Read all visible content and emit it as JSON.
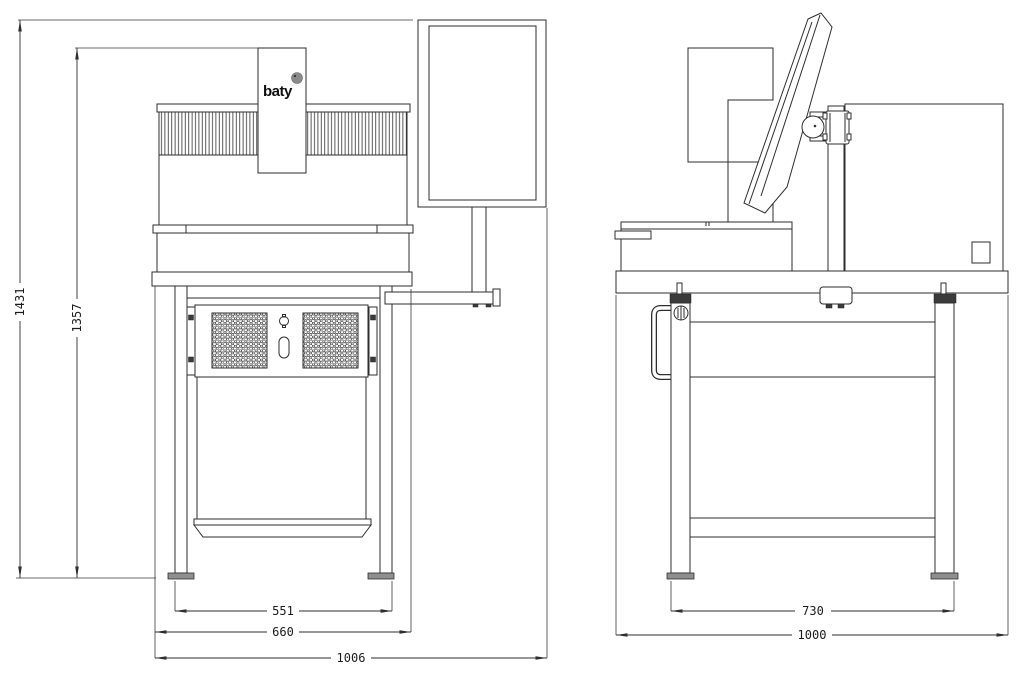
{
  "drawing": {
    "logo": {
      "text": "baty"
    },
    "colors": {
      "line": "#2e2e2e",
      "background": "#ffffff",
      "logo_dot": "#8a8a8a",
      "shading": "#8f8f8f"
    },
    "front_view": {
      "dim_overall_height": "1431",
      "dim_column_height": "1357",
      "dim_leg_width": "551",
      "dim_bench_width": "660",
      "dim_overall_width": "1006"
    },
    "side_view": {
      "dim_leg_depth": "730",
      "dim_overall_depth": "1000"
    }
  }
}
